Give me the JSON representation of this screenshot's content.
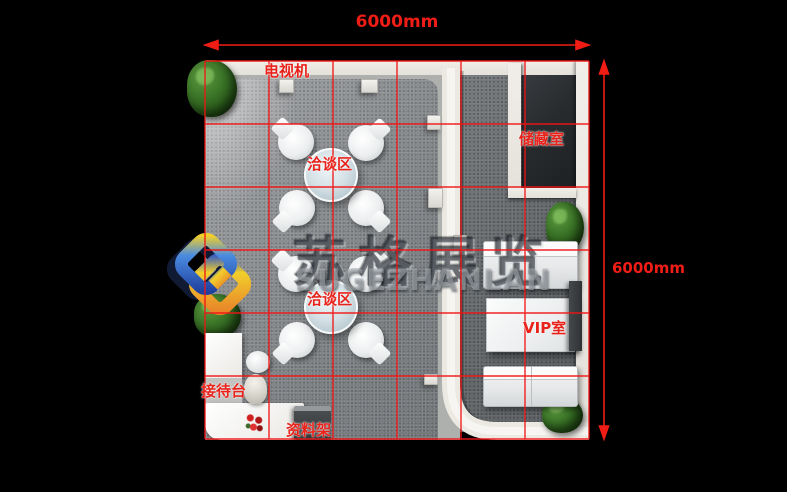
{
  "plan": {
    "type": "exhibition-booth-floor-plan",
    "grid": {
      "columns": 6,
      "rows": 6,
      "cell_size_mm": 1000,
      "line_color": "#f21414"
    },
    "dimensions": {
      "width_label": "6000mm",
      "height_label": "6000mm"
    }
  },
  "labels": {
    "tv": "电视机",
    "meeting": "洽谈区",
    "storage": "储藏室",
    "vip": "VIP室",
    "reception": "接待台",
    "rack": "资料架"
  },
  "watermark": {
    "company_cn": "苏格展览",
    "company_en": "SUGEZHANLAN",
    "logo_colors": {
      "blue": "#3a6fd0",
      "orange": "#ef9327",
      "yellow": "#f2cf2b",
      "navy": "#111a33"
    }
  },
  "colors": {
    "background": "#000000",
    "label_red": "#e8231b",
    "wall_white": "#ece9e3",
    "carpet_main": "#7c8083",
    "carpet_right": "#626669",
    "storage_floor": "#25282b"
  }
}
